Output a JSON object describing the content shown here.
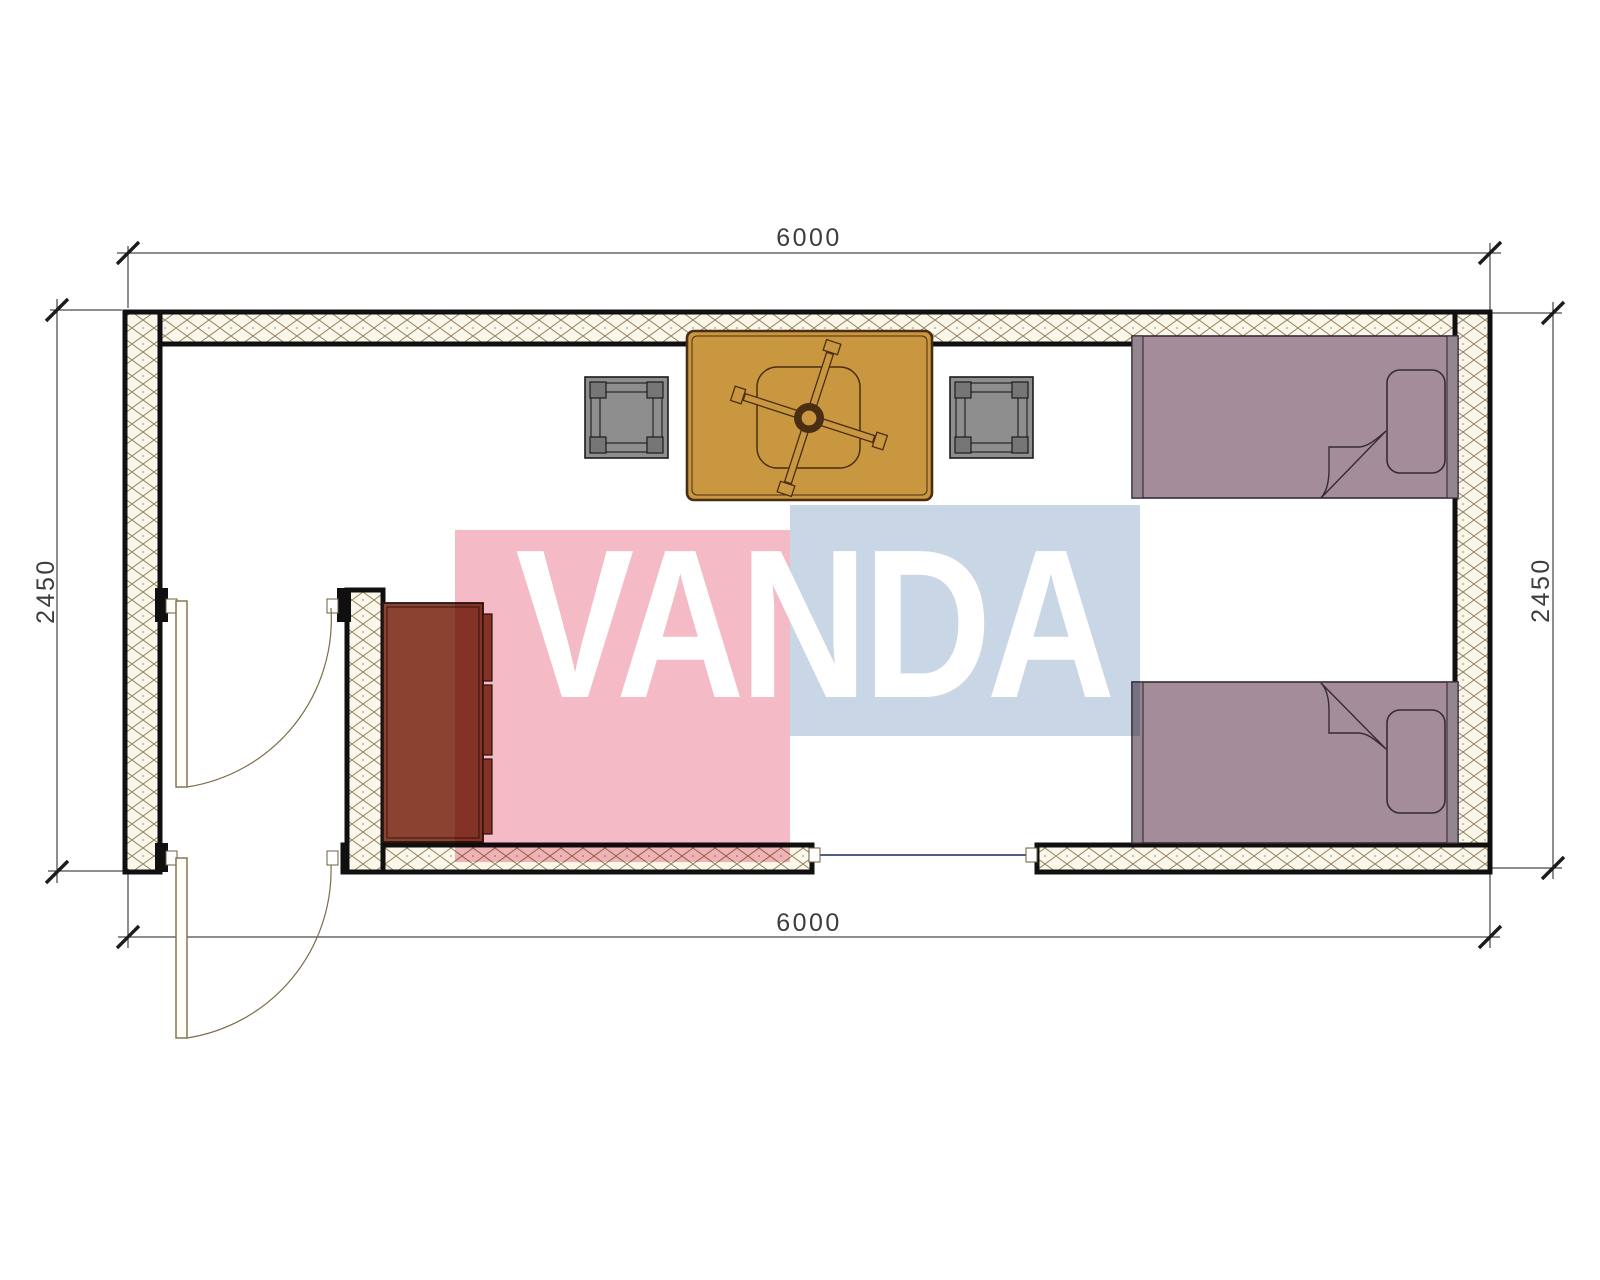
{
  "page": {
    "type": "architectural-floor-plan",
    "background": "#ffffff"
  },
  "watermark": {
    "text": "VANDA"
  },
  "dimensions": {
    "top": "6000",
    "bottom": "6000",
    "left": "2450",
    "right": "2450"
  },
  "plan": {
    "room_width_mm": "6000",
    "room_depth_mm": "2450",
    "objects": [
      "exterior-door",
      "interior-door",
      "window",
      "wardrobe",
      "table",
      "ceiling-fan",
      "stool",
      "stool",
      "single-bed",
      "single-bed"
    ]
  },
  "colors": {
    "wall": "#101010",
    "hatch_line": "#8f815c",
    "hatch_bg": "#faf6ea",
    "dim_line": "#1c1c1c",
    "dim_text": "#3d3d3d",
    "door": "#7d6c48",
    "window": "#3f4470",
    "table": "#c9973f",
    "table_line": "#4a2e14",
    "stool": "#8e8e8e",
    "stool_leg": "#767676",
    "stool_line": "#1c1c1c",
    "bed": "#a48d98",
    "bed_bar": "#93868f",
    "bed_line": "#372a38",
    "cabinet": "#8a4330",
    "cabinet_line": "#2c150e",
    "pink": "#f4bac6",
    "blue": "#c9d6e6",
    "letters": "#ffffff"
  }
}
